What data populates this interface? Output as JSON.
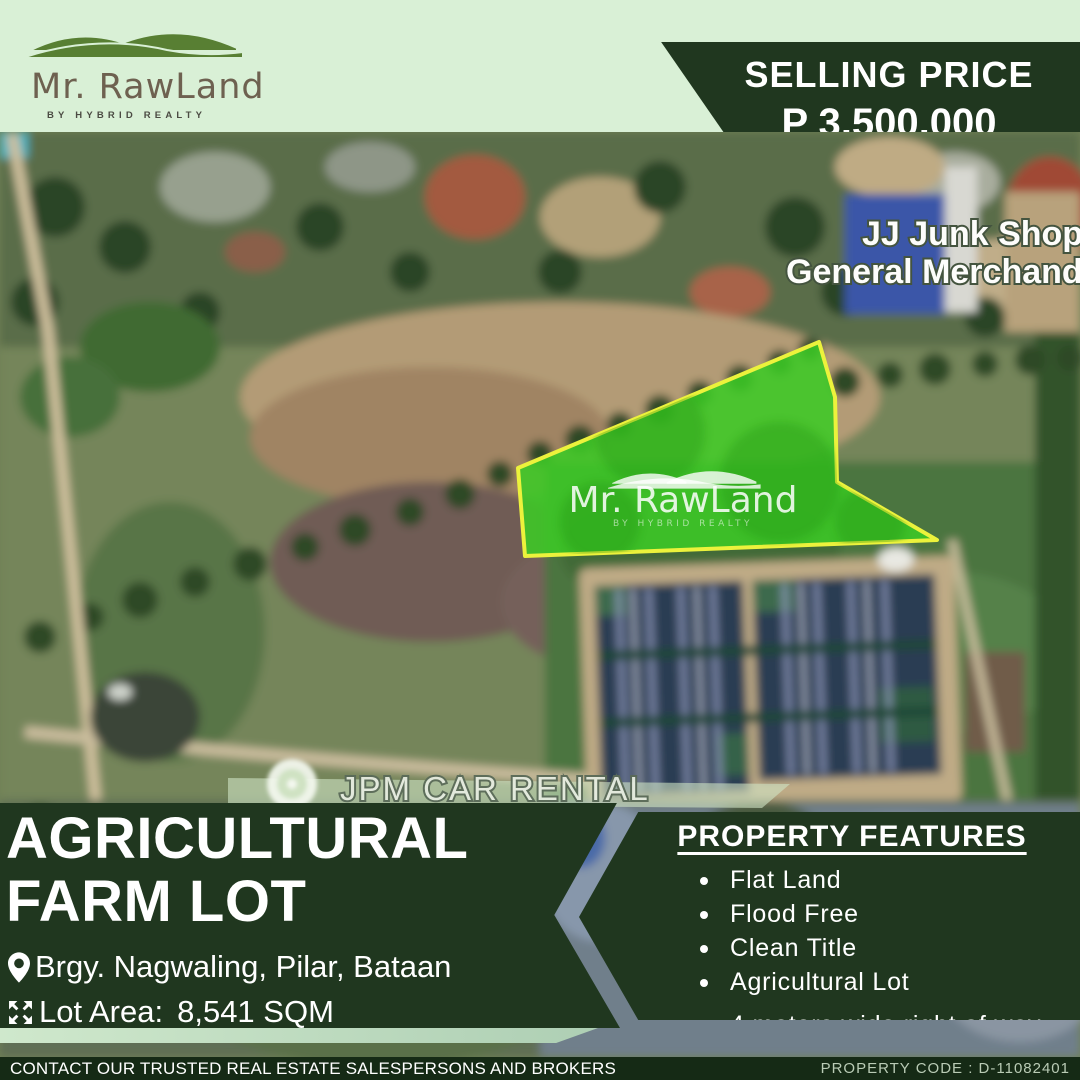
{
  "brand": {
    "name": "Mr. RawLand",
    "tagline": "BY HYBRID REALTY"
  },
  "price_banner": {
    "label": "SELLING PRICE",
    "amount": "P 3,500,000"
  },
  "map": {
    "shop_label_line1": "JJ Junk Shop",
    "shop_label_line2": "General Merchandis",
    "rental_label": "JPM CAR RENTAL",
    "watermark": {
      "name": "Mr. RawLand",
      "tagline": "BY HYBRID REALTY"
    }
  },
  "listing": {
    "title_line1": "AGRICULTURAL",
    "title_line2": "FARM LOT",
    "location": "Brgy. Nagwaling, Pilar, Bataan",
    "lot_area_label": "Lot Area:",
    "lot_area_value": "8,541 SQM"
  },
  "features": {
    "title": "PROPERTY FEATURES",
    "items": [
      "Flat Land",
      "Flood Free",
      "Clean Title",
      "Agricultural Lot",
      "4 meters wide right of way"
    ]
  },
  "footer": {
    "contact": "CONTACT OUR TRUSTED REAL ESTATE SALESPERSONS AND BROKERS",
    "property_code": "PROPERTY CODE : D-11082401"
  },
  "colors": {
    "mint": "#d9f0d6",
    "dark_green": "#20371f",
    "footer_green": "#152a15",
    "lot_fill": "#3cc926",
    "lot_border": "#ecf23c"
  }
}
